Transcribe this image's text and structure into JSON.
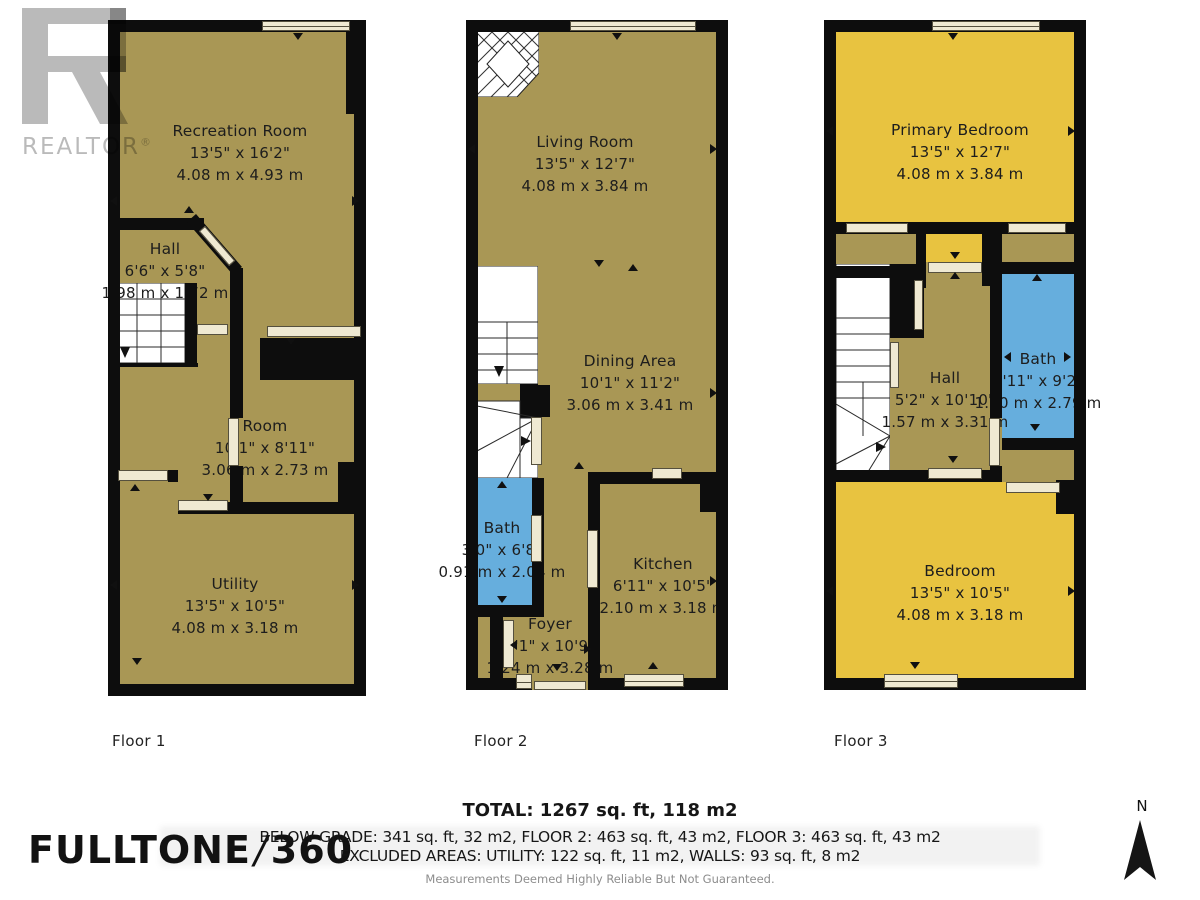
{
  "branding": {
    "realtor": {
      "wordmark": "REALTOR",
      "registered": "®"
    },
    "company": {
      "name": "FULLTONE",
      "slash": "/",
      "suffix": "360"
    }
  },
  "floors": [
    {
      "label": "Floor 1",
      "rooms": [
        {
          "name": "Recreation Room",
          "imperial": "13'5\" x 16'2\"",
          "metric": "4.08 m x 4.93 m"
        },
        {
          "name": "Hall",
          "imperial": "6'6\" x 5'8\"",
          "metric": "1.98 m x 1.72 m"
        },
        {
          "name": "Room",
          "imperial": "10'1\" x 8'11\"",
          "metric": "3.06 m x 2.73 m"
        },
        {
          "name": "Utility",
          "imperial": "13'5\" x 10'5\"",
          "metric": "4.08 m x 3.18 m"
        }
      ]
    },
    {
      "label": "Floor 2",
      "rooms": [
        {
          "name": "Living Room",
          "imperial": "13'5\" x 12'7\"",
          "metric": "4.08 m x 3.84 m"
        },
        {
          "name": "Dining Area",
          "imperial": "10'1\" x 11'2\"",
          "metric": "3.06 m x 3.41 m"
        },
        {
          "name": "Bath",
          "imperial": "3'0\" x 6'8\"",
          "metric": "0.91 m x 2.04 m"
        },
        {
          "name": "Kitchen",
          "imperial": "6'11\" x 10'5\"",
          "metric": "2.10 m x 3.18 m"
        },
        {
          "name": "Foyer",
          "imperial": "4'1\" x 10'9\"",
          "metric": "1.24 m x 3.28 m"
        }
      ]
    },
    {
      "label": "Floor 3",
      "rooms": [
        {
          "name": "Primary Bedroom",
          "imperial": "13'5\" x 12'7\"",
          "metric": "4.08 m x 3.84 m"
        },
        {
          "name": "Hall",
          "imperial": "5'2\" x 10'10\"",
          "metric": "1.57 m x 3.31 m"
        },
        {
          "name": "Bath",
          "imperial": "4'11\" x 9'2\"",
          "metric": "1.50 m x 2.79 m"
        },
        {
          "name": "Bedroom",
          "imperial": "13'5\" x 10'5\"",
          "metric": "4.08 m x 3.18 m"
        }
      ]
    }
  ],
  "summary": {
    "total": "TOTAL: 1267 sq. ft, 118 m2",
    "breakdown": "BELOW GRADE: 341 sq. ft, 32 m2, FLOOR 2: 463 sq. ft, 43 m2, FLOOR 3: 463 sq. ft, 43 m2",
    "excluded": "EXCLUDED AREAS: UTILITY: 122 sq. ft, 11 m2, WALLS: 93 sq. ft, 8 m2",
    "disclaimer": "Measurements Deemed Highly Reliable But Not Guaranteed."
  },
  "compass": {
    "north_label": "N"
  },
  "colors": {
    "room_fill": "#a99755",
    "bedroom_fill": "#e8c340",
    "bath_fill": "#66aedd",
    "wall": "#0d0d0d",
    "opening": "#efe9d2",
    "logo_gray": "#b5b5b5"
  }
}
